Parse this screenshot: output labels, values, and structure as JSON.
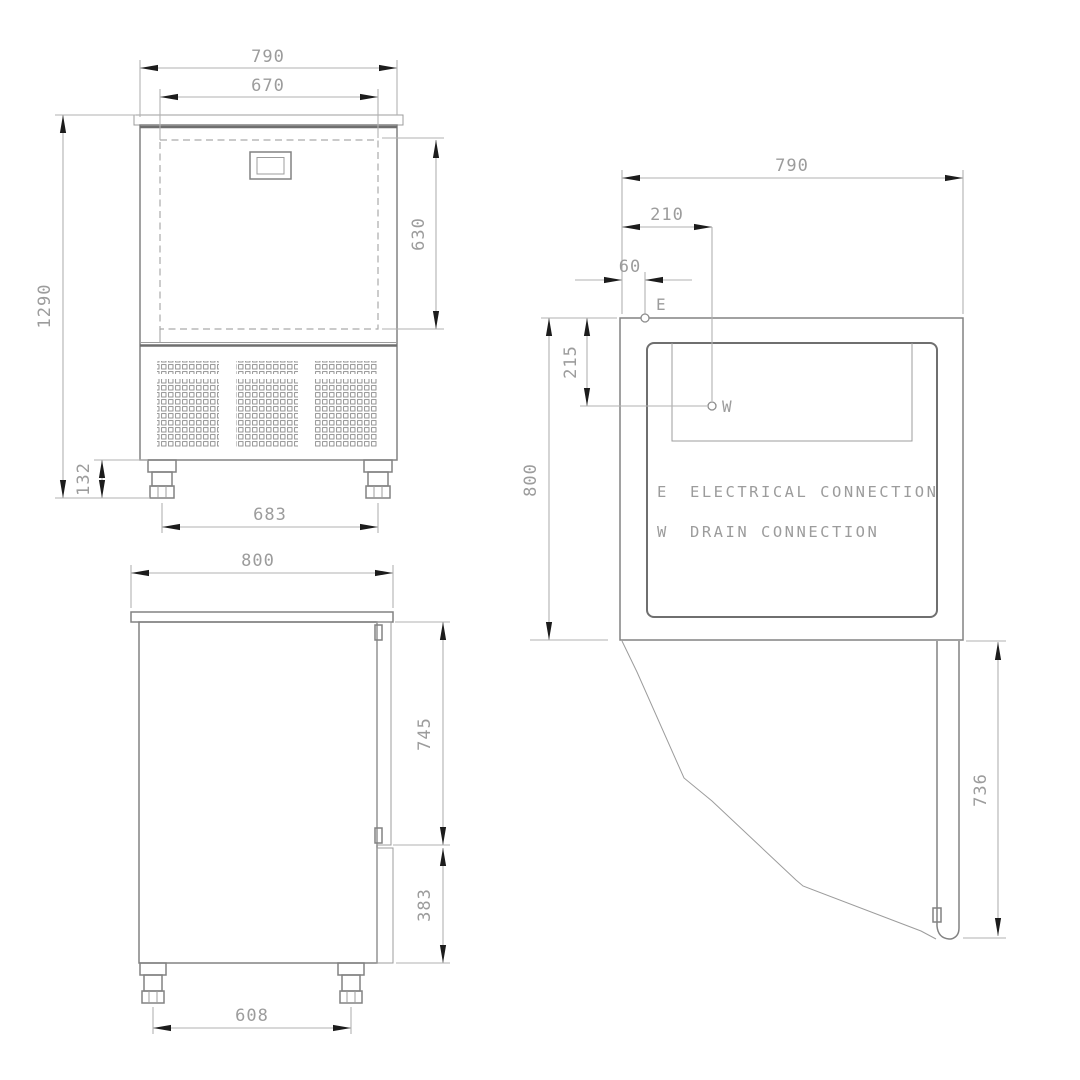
{
  "drawing": {
    "type": "technical-dimension-drawing",
    "views": {
      "front": {
        "dims": {
          "overall_width": "790",
          "inner_width": "670",
          "overall_height": "1290",
          "opening_height": "630",
          "foot_height": "132",
          "foot_spacing": "683"
        }
      },
      "side": {
        "dims": {
          "overall_depth": "800",
          "door_height": "745",
          "base_height": "383",
          "foot_spacing": "608"
        }
      },
      "plan": {
        "dims": {
          "overall_width": "790",
          "drain_offset_x": "210",
          "electrical_offset_x": "60",
          "drain_offset_y": "215",
          "overall_depth": "800",
          "door_width": "736"
        },
        "points": {
          "electrical": "E",
          "drain": "W"
        },
        "legend": [
          {
            "symbol": "E",
            "label": "ELECTRICAL CONNECTION"
          },
          {
            "symbol": "W",
            "label": "DRAIN CONNECTION"
          }
        ]
      }
    },
    "colors": {
      "background": "#ffffff",
      "outline": "#828282",
      "dimension_line": "#b2b2b2",
      "arrow": "#1c1c1c",
      "text": "#9c9c9c"
    }
  }
}
